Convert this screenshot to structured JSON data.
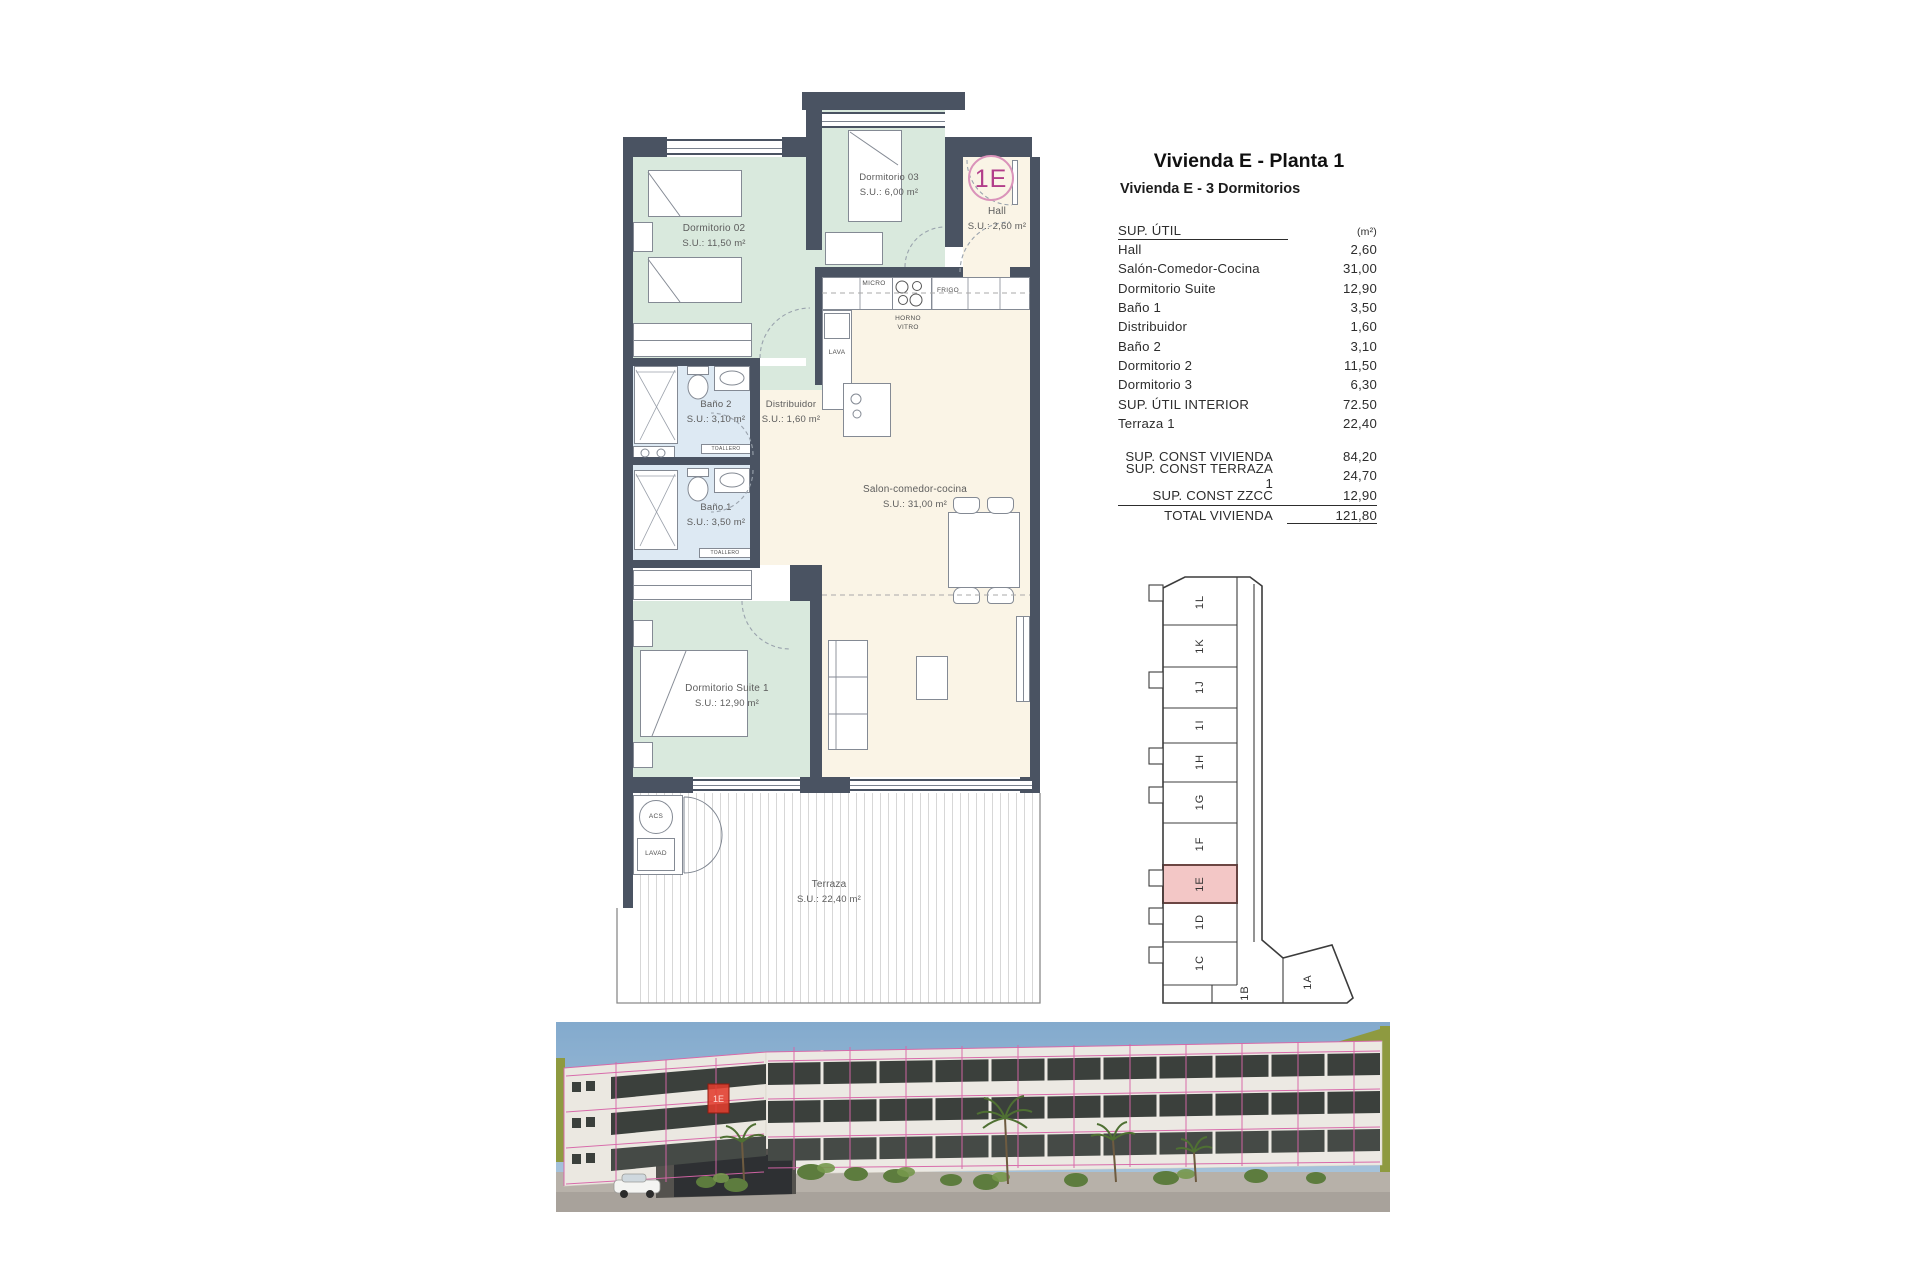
{
  "header": {
    "title": "Vivienda E - Planta 1",
    "subtitle": "Vivienda E - 3 Dormitorios"
  },
  "areas_table": {
    "header_label": "SUP. ÚTIL",
    "header_unit": "(m²)",
    "rows": [
      {
        "label": "Hall",
        "value": "2,60"
      },
      {
        "label": "Salón-Comedor-Cocina",
        "value": "31,00"
      },
      {
        "label": "Dormitorio Suite",
        "value": "12,90"
      },
      {
        "label": "Baño 1",
        "value": "3,50"
      },
      {
        "label": "Distribuidor",
        "value": "1,60"
      },
      {
        "label": "Baño 2",
        "value": "3,10"
      },
      {
        "label": "Dormitorio 2",
        "value": "11,50"
      },
      {
        "label": "Dormitorio 3",
        "value": "6,30"
      },
      {
        "label": "SUP. ÚTIL INTERIOR",
        "value": "72.50"
      },
      {
        "label": "Terraza 1",
        "value": "22,40"
      }
    ]
  },
  "summary_table": {
    "rows": [
      {
        "label": "SUP. CONST VIVIENDA",
        "value": "84,20"
      },
      {
        "label": "SUP. CONST TERRAZA 1",
        "value": "24,70"
      },
      {
        "label": "SUP. CONST ZZCC",
        "value": "12,90"
      },
      {
        "label": "TOTAL VIVIENDA",
        "value": "121,80"
      }
    ]
  },
  "floorplan": {
    "unit_badge": "1E",
    "rooms": {
      "dormitorio02": {
        "name": "Dormitorio 02",
        "area": "S.U.: 11,50 m²"
      },
      "dormitorio03": {
        "name": "Dormitorio 03",
        "area": "S.U.: 6,00 m²"
      },
      "hall": {
        "name": "Hall",
        "area": "S.U.: 2,60 m²"
      },
      "bano2": {
        "name": "Baño 2",
        "area": "S.U.: 3,10 m²"
      },
      "bano1": {
        "name": "Baño 1",
        "area": "S.U.: 3,50 m²"
      },
      "distribuidor": {
        "name": "Distribuidor",
        "area": "S.U.: 1,60 m²"
      },
      "salon": {
        "name": "Salon-comedor-cocina",
        "area": "S.U.: 31,00 m²"
      },
      "suite": {
        "name": "Dormitorio Suite 1",
        "area": "S.U.: 12,90 m²"
      },
      "terraza": {
        "name": "Terraza",
        "area": "S.U.: 22,40 m²"
      }
    },
    "fixtures": {
      "micro": "MICRO",
      "frigo": "FRIGO",
      "horno_vitro": "HORNO VITRO",
      "lava": "LAVA",
      "toallero": "TOALLERO",
      "acs": "ACS",
      "lavad": "LAVAD"
    }
  },
  "key_plan": {
    "units": [
      "1L",
      "1K",
      "1J",
      "1I",
      "1H",
      "1G",
      "1F",
      "1E",
      "1D",
      "1C"
    ],
    "bottom_units": [
      "1B",
      "1A"
    ],
    "highlighted_unit": "1E"
  },
  "render": {
    "highlight_label": "1E"
  },
  "colors": {
    "wall": "#4a5362",
    "room_green": "#d9e9dd",
    "bath_blue": "#dde9f3",
    "cream": "#faf4e6",
    "badge_magenta": "#b23d8a",
    "key_highlight_fill": "#f3c7c6",
    "key_highlight_border": "#9c4f4a",
    "render_pink": "#d765a8",
    "render_red": "#e23c2e"
  }
}
